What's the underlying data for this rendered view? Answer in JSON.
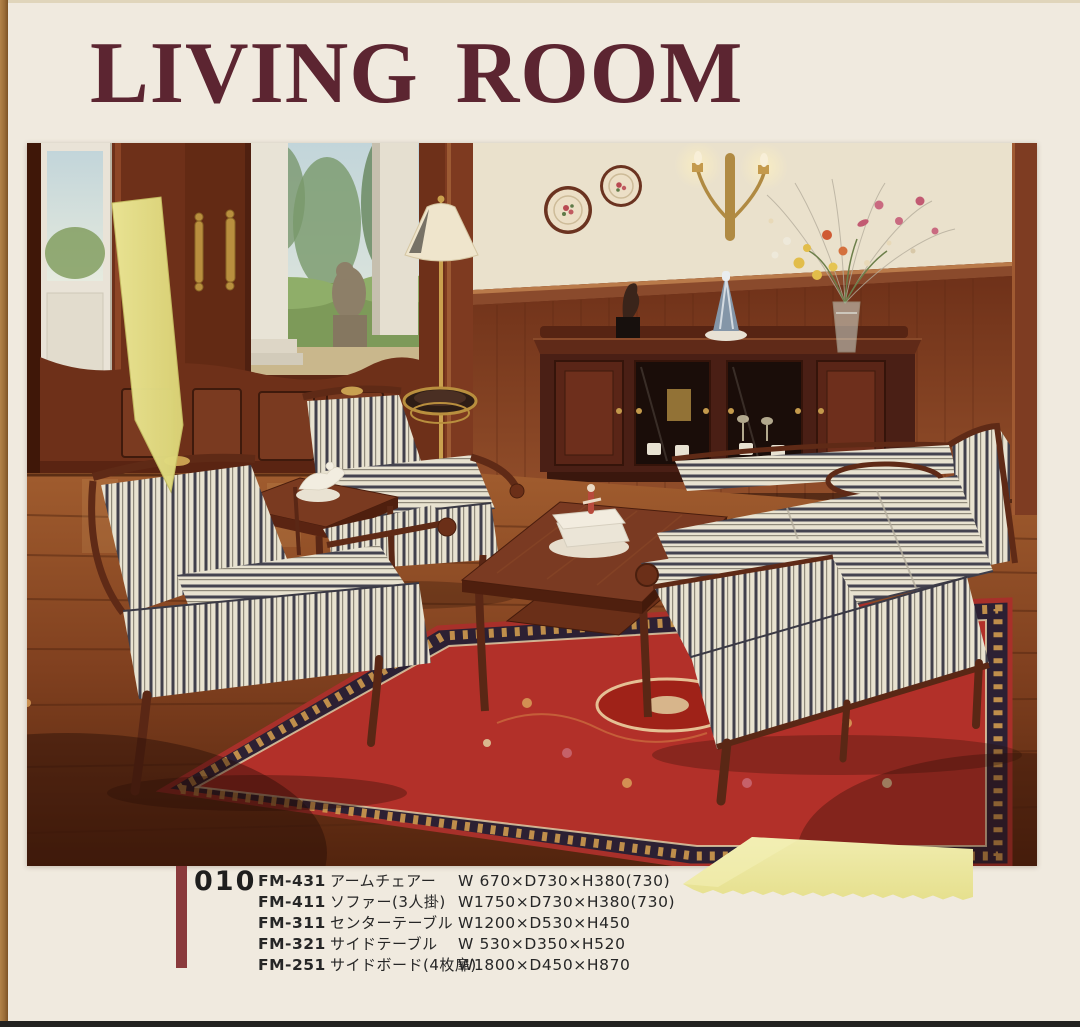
{
  "page": {
    "title": "LIVING ROOM",
    "page_number": "010"
  },
  "products": [
    {
      "code": "FM-431",
      "name": "アームチェアー",
      "size": "W 670×D730×H380(730)"
    },
    {
      "code": "FM-411",
      "name": "ソファー(3人掛)",
      "size": "W1750×D730×H380(730)"
    },
    {
      "code": "FM-311",
      "name": "センターテーブル",
      "size": "W1200×D530×H450"
    },
    {
      "code": "FM-321",
      "name": "サイドテーブル",
      "size": "W 530×D350×H520"
    },
    {
      "code": "FM-251",
      "name": "サイドボード(4枚扉)",
      "size": "W1800×D450×H870"
    }
  ],
  "colors": {
    "title": "#5c2531",
    "accent_bar": "#8a3a3c",
    "page_background": "#f0eadf",
    "sticky_note": "#ebe69c",
    "bookmark_strip": "#e7e388"
  }
}
